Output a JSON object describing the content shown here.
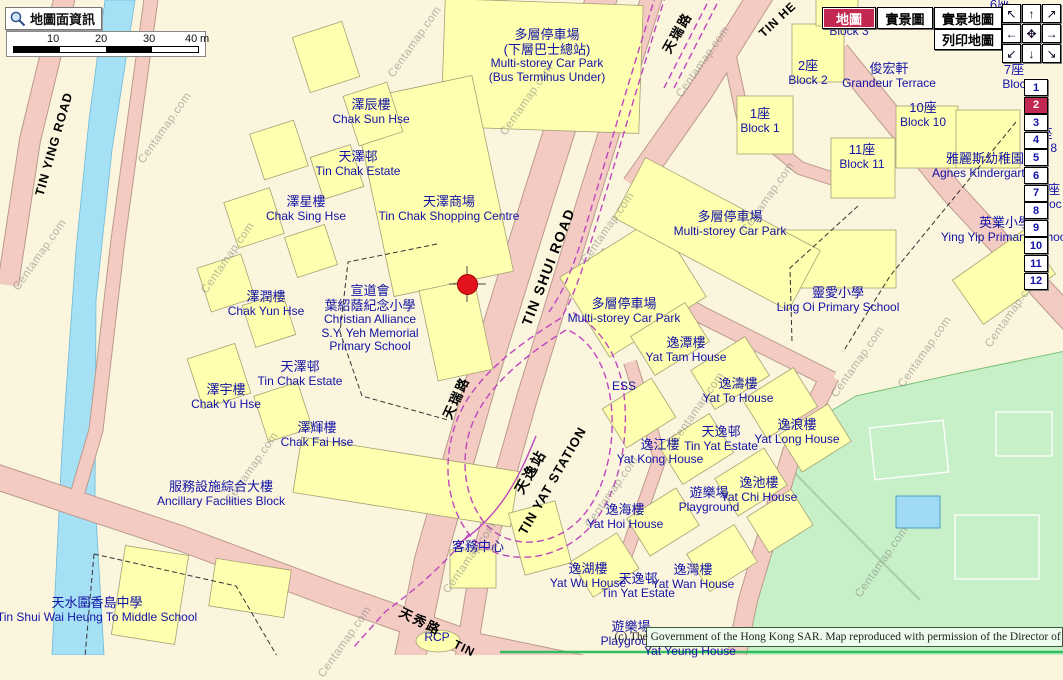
{
  "app": {
    "watermark": "Centamap.com",
    "copyright": "(c) The Government of the Hong Kong SAR. Map reproduced with permission of the Director of Lands."
  },
  "toolbar": {
    "map_info_label": "地圖面資訊",
    "views": [
      {
        "label": "地圖",
        "active": true
      },
      {
        "label": "實景圖",
        "active": false
      },
      {
        "label": "實景地圖",
        "active": false
      },
      {
        "label": "列印地圖",
        "active": false
      }
    ]
  },
  "scalebar": {
    "ticks": [
      "10",
      "20",
      "30",
      "40"
    ],
    "unit": "m"
  },
  "nav_pad": [
    {
      "glyph": "↖",
      "name": "pan-up-left"
    },
    {
      "glyph": "↑",
      "name": "pan-up"
    },
    {
      "glyph": "↗",
      "name": "pan-up-right"
    },
    {
      "glyph": "←",
      "name": "pan-left"
    },
    {
      "glyph": "✥",
      "name": "pan-center"
    },
    {
      "glyph": "→",
      "name": "pan-right"
    },
    {
      "glyph": "↙",
      "name": "pan-down-left"
    },
    {
      "glyph": "↓",
      "name": "pan-down"
    },
    {
      "glyph": "↘",
      "name": "pan-down-right"
    }
  ],
  "floors": {
    "items": [
      "1",
      "2",
      "3",
      "4",
      "5",
      "6",
      "7",
      "8",
      "9",
      "10",
      "11",
      "12"
    ],
    "active": "2"
  },
  "marker": {
    "x": 467,
    "y": 284,
    "color": "#e3131d"
  },
  "colors": {
    "active_red": "#c22850",
    "label_navy": "#1212a6",
    "road_pink": "#f3cbc3",
    "water_blue": "#a5e0f5",
    "park_green": "#c8f0c8"
  },
  "labels": [
    {
      "id": "carpark-bus-terminus",
      "zh": [
        "多層停車場",
        "(下層巴士總站)"
      ],
      "en": [
        "Multi-storey Car Park",
        "(Bus Terminus Under)"
      ],
      "x": 547,
      "y": 28
    },
    {
      "id": "chak-sun-house",
      "zh": [
        "澤辰樓"
      ],
      "en": [
        "Chak Sun Hse"
      ],
      "x": 371,
      "y": 98
    },
    {
      "id": "tin-chak-estate-north",
      "zh": [
        "天澤邨"
      ],
      "en": [
        "Tin Chak Estate"
      ],
      "x": 358,
      "y": 150
    },
    {
      "id": "chak-sing-house",
      "zh": [
        "澤星樓"
      ],
      "en": [
        "Chak Sing Hse"
      ],
      "x": 306,
      "y": 195
    },
    {
      "id": "tin-chak-shopping-centre",
      "zh": [
        "天澤商場"
      ],
      "en": [
        "Tin Chak Shopping Centre"
      ],
      "x": 449,
      "y": 195
    },
    {
      "id": "chak-yun-house",
      "zh": [
        "澤潤樓"
      ],
      "en": [
        "Chak Yun Hse"
      ],
      "x": 266,
      "y": 290
    },
    {
      "id": "sy-yeh-memorial-school",
      "zh": [
        "宣道會",
        "葉紹蔭紀念小學"
      ],
      "en": [
        "Christian Alliance",
        "S.Y. Yeh Memorial",
        "Primary School"
      ],
      "x": 370,
      "y": 284
    },
    {
      "id": "tin-chak-estate-south",
      "zh": [
        "天澤邨"
      ],
      "en": [
        "Tin Chak Estate"
      ],
      "x": 300,
      "y": 360
    },
    {
      "id": "chak-yu-house",
      "zh": [
        "澤宇樓"
      ],
      "en": [
        "Chak Yu Hse"
      ],
      "x": 226,
      "y": 383
    },
    {
      "id": "chak-fai-house",
      "zh": [
        "澤輝樓"
      ],
      "en": [
        "Chak Fai Hse"
      ],
      "x": 317,
      "y": 421
    },
    {
      "id": "ancillary-facilities-block",
      "zh": [
        "服務設施綜合大樓"
      ],
      "en": [
        "Ancillary Facilities Block"
      ],
      "x": 221,
      "y": 480
    },
    {
      "id": "heung-to-middle-school",
      "zh": [
        "天水圍香島中學"
      ],
      "en": [
        "Tin Shui Wai Heung To Middle School"
      ],
      "x": 97,
      "y": 596
    },
    {
      "id": "customer-service-centre",
      "zh": [
        "客務中心"
      ],
      "en": [],
      "x": 478,
      "y": 540
    },
    {
      "id": "rcp",
      "zh": [],
      "en": [
        "RCP"
      ],
      "x": 437,
      "y": 631
    },
    {
      "id": "playground-south",
      "zh": [
        "遊樂場"
      ],
      "en": [
        "Playground"
      ],
      "x": 631,
      "y": 620
    },
    {
      "id": "yat-yeung-house",
      "zh": [],
      "en": [
        "Yat Yeung House"
      ],
      "x": 690,
      "y": 645
    },
    {
      "id": "yat-wu-house",
      "zh": [
        "逸湖樓"
      ],
      "en": [
        "Yat Wu House"
      ],
      "x": 588,
      "y": 562
    },
    {
      "id": "tin-yat-estate-south",
      "zh": [
        "天逸邨"
      ],
      "en": [
        "Tin Yat Estate"
      ],
      "x": 638,
      "y": 572
    },
    {
      "id": "yat-wan-house",
      "zh": [
        "逸灣樓"
      ],
      "en": [
        "Yat Wan House"
      ],
      "x": 693,
      "y": 563
    },
    {
      "id": "yat-hoi-house",
      "zh": [
        "逸海樓"
      ],
      "en": [
        "Yat Hoi House"
      ],
      "x": 625,
      "y": 503
    },
    {
      "id": "yat-kong-house",
      "zh": [
        "逸江樓"
      ],
      "en": [
        "Yat Kong House"
      ],
      "x": 660,
      "y": 438
    },
    {
      "id": "tin-yat-estate-mid",
      "zh": [
        "天逸邨"
      ],
      "en": [
        "Tin Yat Estate"
      ],
      "x": 721,
      "y": 425
    },
    {
      "id": "yat-long-house",
      "zh": [
        "逸浪樓"
      ],
      "en": [
        "Yat Long House"
      ],
      "x": 797,
      "y": 418
    },
    {
      "id": "yat-chi-house",
      "zh": [
        "逸池樓"
      ],
      "en": [
        "Yat Chi House"
      ],
      "x": 759,
      "y": 476
    },
    {
      "id": "playground-east",
      "zh": [
        "遊樂場"
      ],
      "en": [
        "Playground"
      ],
      "x": 709,
      "y": 486
    },
    {
      "id": "yat-tam-house",
      "zh": [
        "逸潭樓"
      ],
      "en": [
        "Yat Tam House"
      ],
      "x": 686,
      "y": 336
    },
    {
      "id": "yat-to-house",
      "zh": [
        "逸濤樓"
      ],
      "en": [
        "Yat To House"
      ],
      "x": 738,
      "y": 377
    },
    {
      "id": "ess",
      "zh": [],
      "en": [
        "ESS"
      ],
      "x": 624,
      "y": 380
    },
    {
      "id": "carpark-mid",
      "zh": [
        "多層停車場"
      ],
      "en": [
        "Multi-storey Car Park"
      ],
      "x": 624,
      "y": 297
    },
    {
      "id": "carpark-east",
      "zh": [
        "多層停車場"
      ],
      "en": [
        "Multi-storey Car Park"
      ],
      "x": 730,
      "y": 210
    },
    {
      "id": "ling-oi-primary-school",
      "zh": [
        "靈愛小學"
      ],
      "en": [
        "Ling Oi Primary School"
      ],
      "x": 838,
      "y": 286
    },
    {
      "id": "ying-yip-primary-school",
      "zh": [
        "英業小學"
      ],
      "en": [
        "Ying Yip Primary School"
      ],
      "x": 1005,
      "y": 216
    },
    {
      "id": "agnes-kindergarten",
      "zh": [
        "雅麗斯幼稚園"
      ],
      "en": [
        "Agnes Kindergarten"
      ],
      "x": 985,
      "y": 152
    },
    {
      "id": "grandeur-terrace",
      "zh": [
        "俊宏軒"
      ],
      "en": [
        "Grandeur Terrace"
      ],
      "x": 889,
      "y": 62
    },
    {
      "id": "block-2",
      "zh": [
        "2座"
      ],
      "en": [
        "Block 2"
      ],
      "x": 808,
      "y": 59
    },
    {
      "id": "block-1",
      "zh": [
        "1座"
      ],
      "en": [
        "Block 1"
      ],
      "x": 760,
      "y": 107
    },
    {
      "id": "block-10",
      "zh": [
        "10座"
      ],
      "en": [
        "Block 10"
      ],
      "x": 923,
      "y": 101
    },
    {
      "id": "block-11",
      "zh": [
        "11座"
      ],
      "en": [
        "Block 11"
      ],
      "x": 862,
      "y": 143
    },
    {
      "id": "block-3",
      "zh": [],
      "en": [
        "Block 3"
      ],
      "x": 849,
      "y": 25
    },
    {
      "id": "block-6-fragment",
      "zh": [
        "6座"
      ],
      "en": [],
      "x": 1000,
      "y": -2
    },
    {
      "id": "block-fragment-blo",
      "zh": [],
      "en": [
        "Blo"
      ],
      "x": 993,
      "y": 17
    },
    {
      "id": "block-7",
      "zh": [
        "7座"
      ],
      "en": [
        "Bloc"
      ],
      "x": 1014,
      "y": 63
    },
    {
      "id": "block-8-fragment",
      "zh": [
        "座"
      ],
      "en": [
        "ck 8"
      ],
      "x": 1046,
      "y": 127
    },
    {
      "id": "block-9-fragment",
      "zh": [
        "9座"
      ],
      "en": [
        "Bloc"
      ],
      "x": 1050,
      "y": 183
    },
    {
      "id": "tin-ying-road",
      "zh": [],
      "en": [
        "TIN YING ROAD"
      ],
      "x": 54,
      "y": 144,
      "rot": -74,
      "cls": "black",
      "size": 12.5,
      "bold": true,
      "ls": 1
    },
    {
      "id": "tin-shui-road",
      "zh": [],
      "en": [
        "TIN SHUI ROAD"
      ],
      "x": 549,
      "y": 267,
      "rot": -69,
      "cls": "black",
      "size": 14,
      "bold": true,
      "ls": 1.5
    },
    {
      "id": "tin-shui-road-zh-mid",
      "zh": [
        "天瑞路"
      ],
      "en": [],
      "x": 457,
      "y": 398,
      "rot": -65,
      "cls": "black",
      "size": 13,
      "bold": true,
      "ls": 2
    },
    {
      "id": "tin-shui-road-zh-top",
      "zh": [
        "天瑞路"
      ],
      "en": [],
      "x": 678,
      "y": 33,
      "rot": -60,
      "cls": "black",
      "size": 13,
      "bold": true,
      "ls": 2
    },
    {
      "id": "tin-sau-road-zh",
      "zh": [
        "天秀路"
      ],
      "en": [],
      "x": 420,
      "y": 622,
      "rot": 26,
      "cls": "black",
      "size": 13,
      "bold": true,
      "ls": 2
    },
    {
      "id": "tin-sau-road-en-fragment",
      "zh": [],
      "en": [
        "TIN"
      ],
      "x": 464,
      "y": 649,
      "rot": 26,
      "cls": "black",
      "size": 12,
      "bold": true,
      "ls": 1
    },
    {
      "id": "tin-he-road-fragment",
      "zh": [],
      "en": [
        "TIN HE"
      ],
      "x": 778,
      "y": 20,
      "rot": -43,
      "cls": "black",
      "size": 12,
      "bold": true,
      "ls": 1
    },
    {
      "id": "tin-yat-station-zh",
      "zh": [
        "天逸站"
      ],
      "en": [],
      "x": 531,
      "y": 472,
      "rot": -60,
      "cls": "black",
      "size": 14,
      "bold": true,
      "ls": 2
    },
    {
      "id": "tin-yat-station-en",
      "zh": [],
      "en": [
        "TIN YAT STATION"
      ],
      "x": 553,
      "y": 481,
      "rot": -60,
      "cls": "black",
      "size": 13,
      "bold": true,
      "ls": 1
    }
  ],
  "watermarks": [
    [
      40,
      255
    ],
    [
      228,
      258
    ],
    [
      415,
      42
    ],
    [
      527,
      100
    ],
    [
      252,
      468
    ],
    [
      608,
      228
    ],
    [
      703,
      62
    ],
    [
      768,
      198
    ],
    [
      858,
      362
    ],
    [
      612,
      492
    ],
    [
      470,
      558
    ],
    [
      345,
      642
    ],
    [
      1012,
      312
    ],
    [
      882,
      562
    ],
    [
      698,
      408
    ],
    [
      165,
      128
    ],
    [
      925,
      352
    ]
  ]
}
